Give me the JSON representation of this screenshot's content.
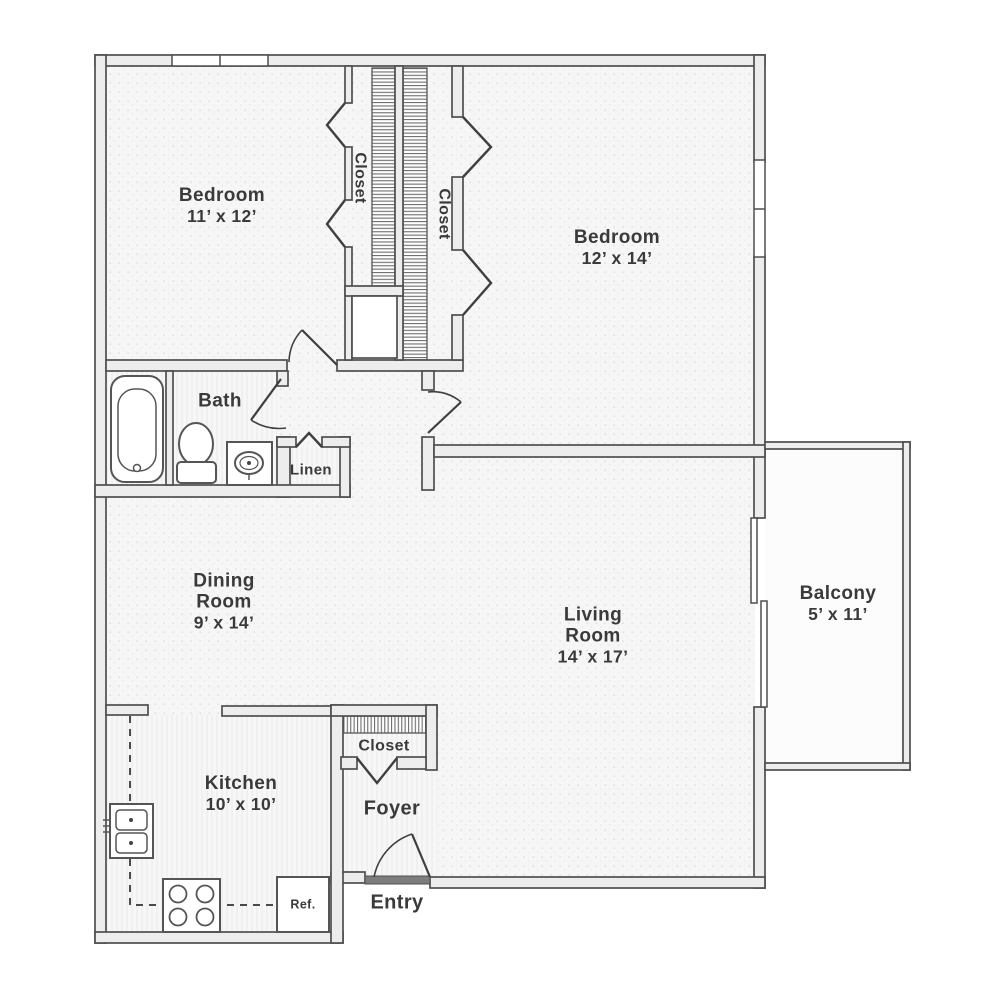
{
  "rooms": {
    "bedroom1": {
      "name": "Bedroom",
      "dims": "11’ x 12’"
    },
    "bedroom2": {
      "name": "Bedroom",
      "dims": "12’ x 14’"
    },
    "closet1": {
      "name": "Closet"
    },
    "closet2": {
      "name": "Closet"
    },
    "bath": {
      "name": "Bath"
    },
    "linen": {
      "name": "Linen"
    },
    "dining_room": {
      "lines": [
        "Dining",
        "Room",
        "9’ x 14’"
      ]
    },
    "living_room": {
      "lines": [
        "Living",
        "Room",
        "14’ x 17’"
      ]
    },
    "balcony": {
      "name": "Balcony",
      "dims": "5’ x 11’"
    },
    "kitchen": {
      "name": "Kitchen",
      "dims": "10’ x 10’"
    },
    "foyer_closet": {
      "name": "Closet"
    },
    "foyer": {
      "name": "Foyer"
    },
    "entry": {
      "name": "Entry"
    }
  },
  "fixtures": {
    "refrigerator_label": "Ref."
  },
  "colors": {
    "wall_line": "#4f4f4f",
    "wall_fill": "#ededed",
    "floor_tint": "#f6f6f6",
    "label_text": "#3a3a3a",
    "background": "#ffffff"
  }
}
